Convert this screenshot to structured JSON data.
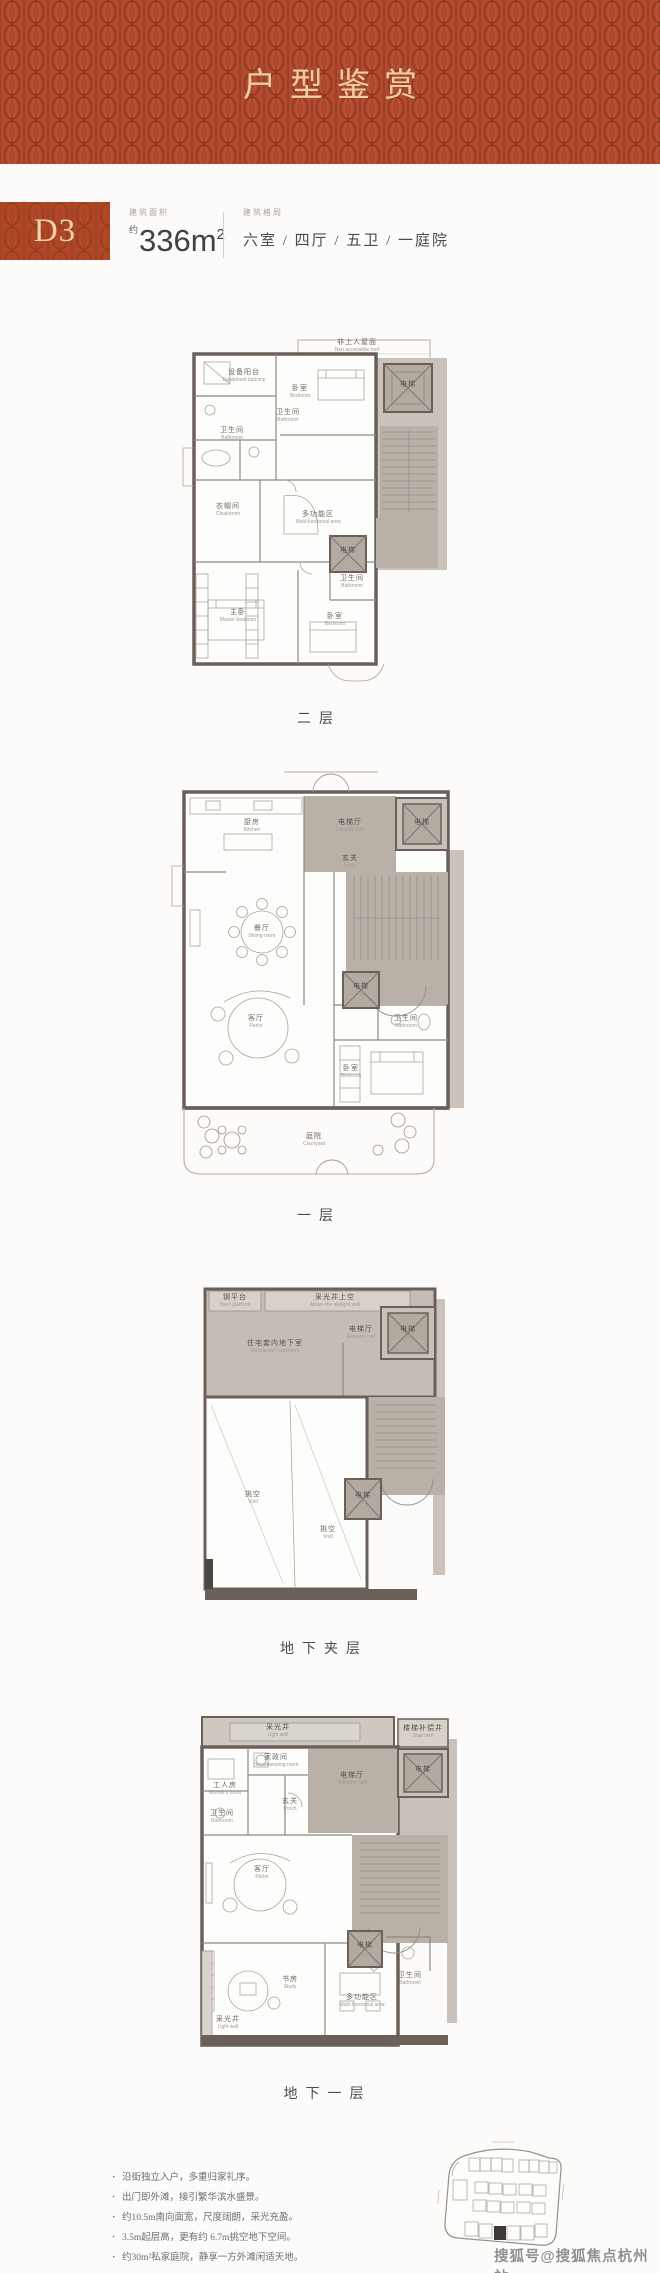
{
  "banner": {
    "title": "户型鉴赏"
  },
  "header": {
    "unit": "D3",
    "area_label": "建筑面积",
    "area_prefix": "约",
    "area_value": "336m",
    "area_sup": "2",
    "layout_label": "建筑格局",
    "layout_value": "六室 / 四厅 / 五卫 / 一庭院"
  },
  "plans": [
    {
      "caption": "二层",
      "rooms": [
        {
          "zh": "非上人屋面",
          "en": "Non-accessible roof"
        },
        {
          "zh": "设备阳台",
          "en": "Equipment balcony"
        },
        {
          "zh": "卧室",
          "en": "Bedroom"
        },
        {
          "zh": "电梯",
          "en": "Lift"
        },
        {
          "zh": "卫生间",
          "en": "Bathroom"
        },
        {
          "zh": "卫生间",
          "en": "Bathroom"
        },
        {
          "zh": "衣帽间",
          "en": "Cloakroom"
        },
        {
          "zh": "多功能区",
          "en": "Multi-functional area"
        },
        {
          "zh": "电梯",
          "en": "Lift"
        },
        {
          "zh": "卫生间",
          "en": "Bathroom"
        },
        {
          "zh": "主卧",
          "en": "Master bedroom"
        },
        {
          "zh": "卧室",
          "en": "Bedroom"
        }
      ]
    },
    {
      "caption": "一层",
      "rooms": [
        {
          "zh": "厨房",
          "en": "Kitchen"
        },
        {
          "zh": "电梯厅",
          "en": "Elevator hall"
        },
        {
          "zh": "电梯",
          "en": "Lift"
        },
        {
          "zh": "玄关",
          "en": "Porch"
        },
        {
          "zh": "餐厅",
          "en": "Dining room"
        },
        {
          "zh": "电梯",
          "en": "Lift"
        },
        {
          "zh": "客厅",
          "en": "Parlor"
        },
        {
          "zh": "卫生间",
          "en": "Bathroom"
        },
        {
          "zh": "卧室",
          "en": "Bedroom"
        },
        {
          "zh": "庭院",
          "en": "Courtyard"
        }
      ]
    },
    {
      "caption": "地下夹层",
      "rooms": [
        {
          "zh": "钢平台",
          "en": "Steel platform"
        },
        {
          "zh": "采光井上空",
          "en": "Above the skylight well"
        },
        {
          "zh": "住宅套内地下室",
          "en": "Residential basement"
        },
        {
          "zh": "电梯厅",
          "en": "Elevator hall"
        },
        {
          "zh": "电梯",
          "en": "Lift"
        },
        {
          "zh": "挑空",
          "en": "Void"
        },
        {
          "zh": "挑空",
          "en": "Void"
        },
        {
          "zh": "电梯",
          "en": "Lift"
        }
      ]
    },
    {
      "caption": "地下一层",
      "rooms": [
        {
          "zh": "采光井",
          "en": "Light well"
        },
        {
          "zh": "楼梯补偿井",
          "en": "Stair well"
        },
        {
          "zh": "家政间",
          "en": "Housekeeping room"
        },
        {
          "zh": "工人房",
          "en": "Worker's room"
        },
        {
          "zh": "卫生间",
          "en": "Bathroom"
        },
        {
          "zh": "玄关",
          "en": "Porch"
        },
        {
          "zh": "电梯厅",
          "en": "Elevator hall"
        },
        {
          "zh": "电梯",
          "en": "Lift"
        },
        {
          "zh": "客厅",
          "en": "Parlor"
        },
        {
          "zh": "电梯",
          "en": "Lift"
        },
        {
          "zh": "卫生间",
          "en": "Bathroom"
        },
        {
          "zh": "书房",
          "en": "Study"
        },
        {
          "zh": "多功能区",
          "en": "Multi-functional area"
        },
        {
          "zh": "采光井",
          "en": "Light well"
        }
      ]
    }
  ],
  "notes": [
    "沿街独立入户，多重归家礼序。",
    "出门即外滩，接引繁华滨水盛景。",
    "约10.5m南向面宽，尺度阔朗，采光充盈。",
    "3.5m起层高，更有约 6.7m挑空地下空间。",
    "约30m²私家庭院，静享一方外滩闲适天地。"
  ],
  "watermark": "搜狐号@搜狐焦点杭州站",
  "colors": {
    "banner_red": "#b04a2c",
    "gold": "#ecd0a6",
    "plan_gray": "#b9b0a8",
    "wall": "#6b6059"
  }
}
